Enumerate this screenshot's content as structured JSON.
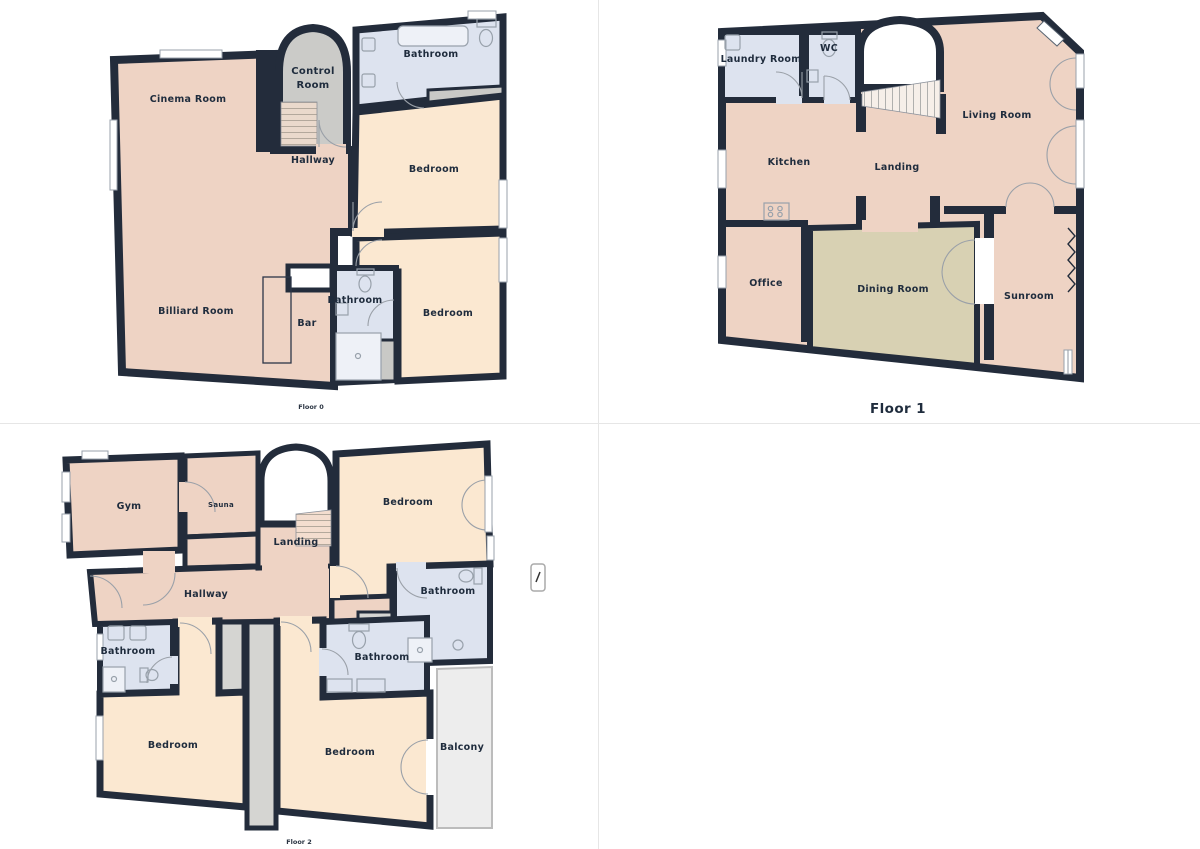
{
  "title": "Property floor plans",
  "colors": {
    "wall": "#232c3b",
    "room_warm": "#eed3c4",
    "room_cream": "#fbe8d1",
    "room_wet": "#dde3ef",
    "room_gray": "#cbcbc8",
    "room_khaki": "#d8d1b3",
    "shaft": "#d5d5d2",
    "balcony": "#ededed",
    "label": "#1f2c3d"
  },
  "floors": [
    {
      "name": "Floor 0",
      "rooms": [
        {
          "label": "Cinema Room"
        },
        {
          "label": "Control Room",
          "line1": "Control",
          "line2": "Room"
        },
        {
          "label": "Bathroom"
        },
        {
          "label": "Bedroom"
        },
        {
          "label": "Hallway"
        },
        {
          "label": "Billiard Room"
        },
        {
          "label": "Bar"
        },
        {
          "label": "Bathroom"
        },
        {
          "label": "Bedroom"
        }
      ]
    },
    {
      "name": "Floor 1",
      "rooms": [
        {
          "label": "Laundry Room"
        },
        {
          "label": "WC"
        },
        {
          "label": "Living Room"
        },
        {
          "label": "Kitchen"
        },
        {
          "label": "Landing"
        },
        {
          "label": "Office"
        },
        {
          "label": "Dining Room"
        },
        {
          "label": "Sunroom"
        }
      ]
    },
    {
      "name": "Floor 2",
      "rooms": [
        {
          "label": "Gym"
        },
        {
          "label": "Sauna"
        },
        {
          "label": "Landing"
        },
        {
          "label": "Bedroom"
        },
        {
          "label": "Hallway"
        },
        {
          "label": "Bathroom"
        },
        {
          "label": "Bathroom"
        },
        {
          "label": "Bathroom"
        },
        {
          "label": "Bedroom"
        },
        {
          "label": "Bedroom"
        },
        {
          "label": "Balcony"
        }
      ]
    }
  ]
}
